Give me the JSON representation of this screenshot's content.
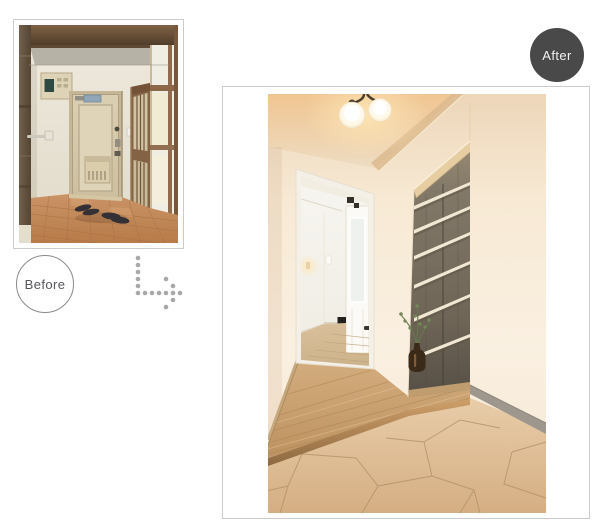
{
  "page": {
    "background_color": "#ffffff"
  },
  "badges": {
    "before": {
      "label": "Before",
      "text_color": "#55565b",
      "border_color": "#8b8b8b",
      "background_color": "#ffffff"
    },
    "after": {
      "label": "After",
      "text_color": "#f1f1f1",
      "background_color": "#494949"
    }
  },
  "photos": {
    "before": {
      "name": "entryway-before-renovation-photo",
      "border_color": "#cbcbcb"
    },
    "after": {
      "name": "entryway-after-renovation-photo",
      "border_color": "#cbcbcb"
    }
  },
  "arrow": {
    "style": "dotted-elbow-down-right",
    "dot_color": "#a8a8a8"
  }
}
